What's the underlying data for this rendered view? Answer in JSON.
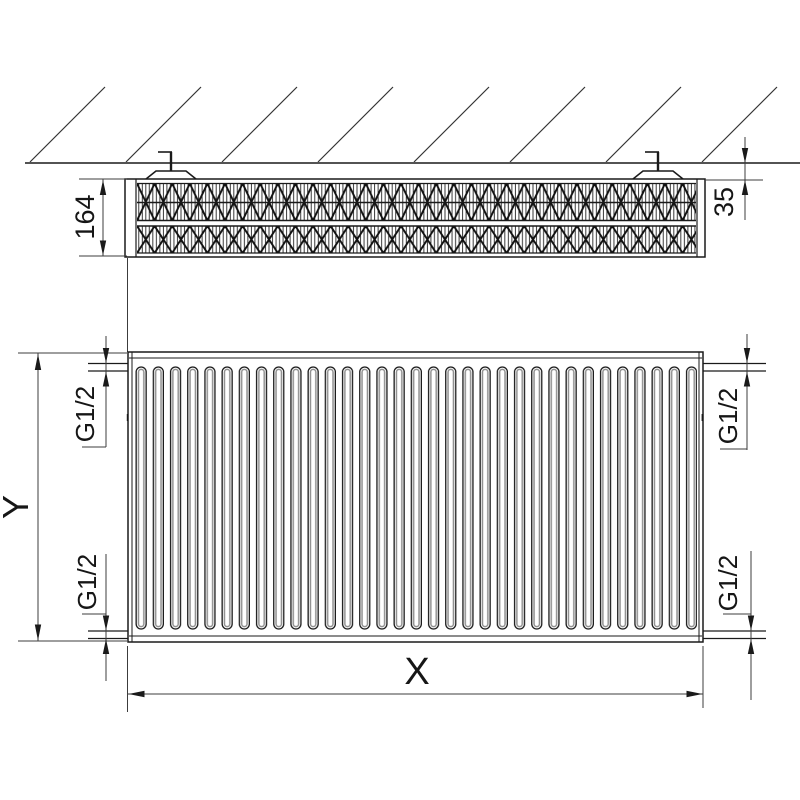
{
  "labels": {
    "depth": "164",
    "wall_distance": "35",
    "height": "Y",
    "length": "X",
    "thread_top_left": "G1/2",
    "thread_top_right": "G1/2",
    "thread_bottom_left": "G1/2",
    "thread_bottom_right": "G1/2"
  },
  "colors": {
    "line": "#1a1a1a",
    "dim_line": "#3c3c3c",
    "channel_shade": "#8f8f8f",
    "background": "#ffffff"
  }
}
